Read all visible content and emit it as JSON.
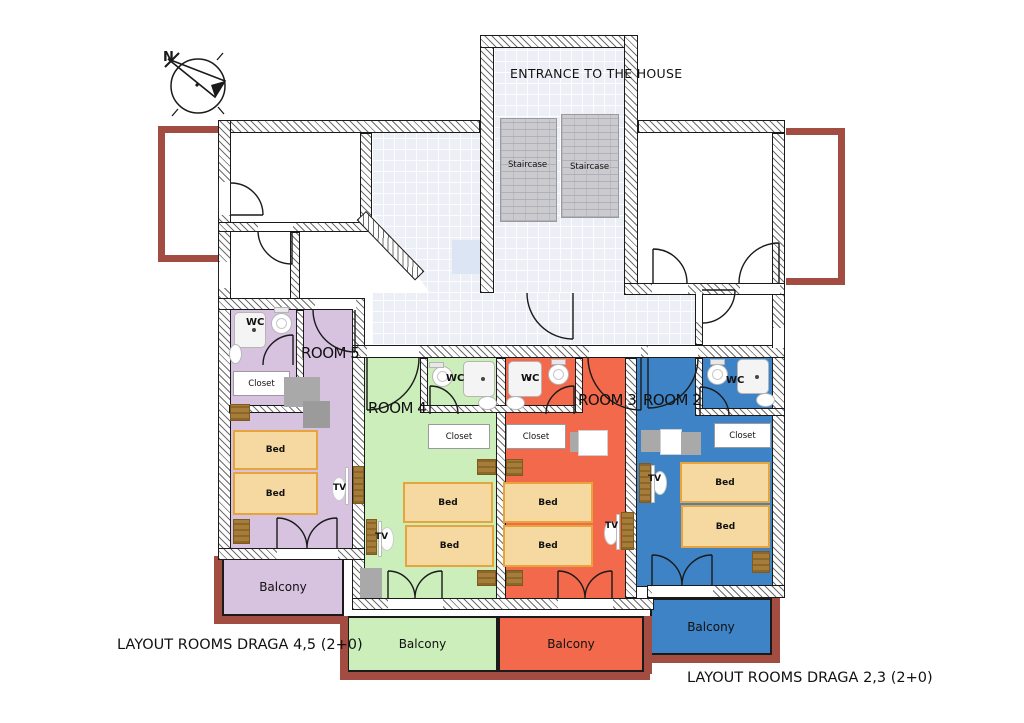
{
  "compass_label": "N",
  "entrance": {
    "title": "ENTRANCE TO THE HOUSE",
    "staircase_left": "Staircase",
    "staircase_right": "Staircase"
  },
  "rooms": [
    {
      "name": "ROOM 5",
      "color": "#d7c3e0"
    },
    {
      "name": "ROOM 4",
      "color": "#cbeebb"
    },
    {
      "name": "ROOM 3",
      "color": "#f3694b"
    },
    {
      "name": "ROOM 2",
      "color": "#3d83c5"
    }
  ],
  "labels": {
    "wc": "WC",
    "closet": "Closet",
    "bed": "Bed",
    "tv": "TV",
    "balcony": "Balcony"
  },
  "captions": {
    "bottom_left": "LAYOUT ROOMS DRAGA 4,5 (2+0)",
    "bottom_right": "LAYOUT ROOMS DRAGA 2,3 (2+0)"
  },
  "colors": {
    "bed_fill": "#f6d9a0",
    "bed_border": "#e8a43c",
    "terrace_maroon": "#a34c41",
    "corridor_tile": "#eceff6",
    "staircase_gray": "#cbcbcf",
    "room5_purple": "#d7c3e0",
    "room4_green": "#cbeebb",
    "room3_orange": "#f3694b",
    "room2_blue": "#3d83c5"
  }
}
